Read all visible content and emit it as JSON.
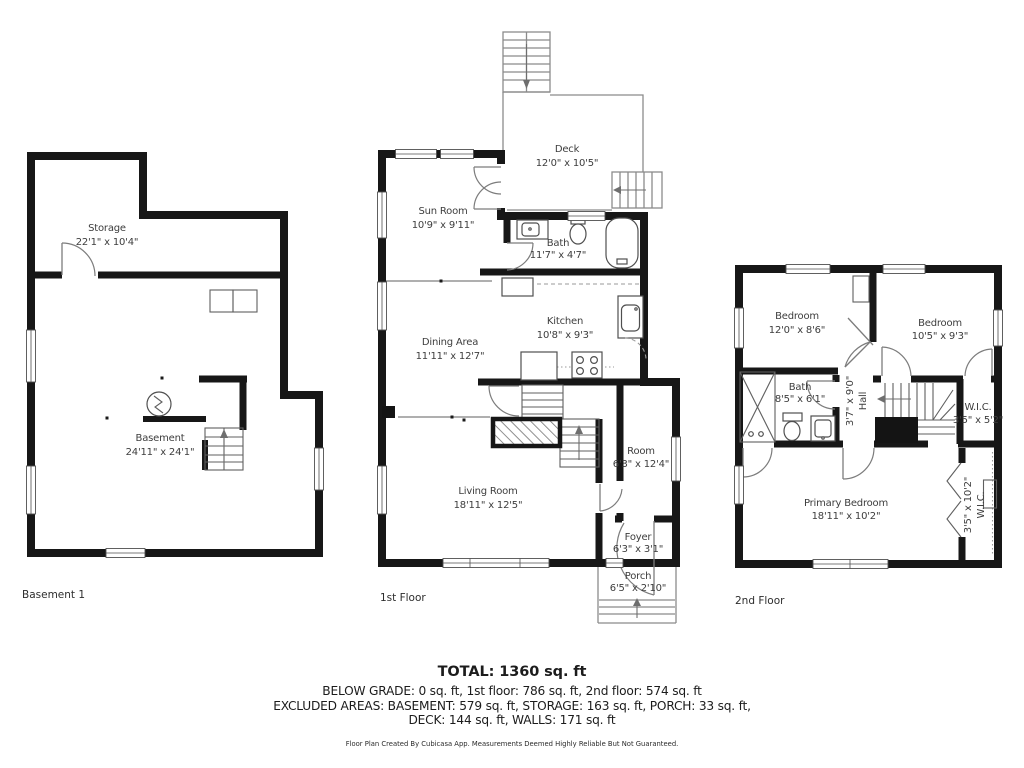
{
  "colors": {
    "wall": "#171717",
    "thin_line": "#8b8b8b",
    "label": "#3d3d3d",
    "background": "#ffffff"
  },
  "floors": [
    {
      "label": "Basement 1",
      "rooms": [
        {
          "name": "Storage",
          "dims": "22'1\" x 10'4\""
        },
        {
          "name": "Basement",
          "dims": "24'11\" x 24'1\""
        }
      ]
    },
    {
      "label": "1st Floor",
      "rooms": [
        {
          "name": "Deck",
          "dims": "12'0\" x 10'5\""
        },
        {
          "name": "Sun Room",
          "dims": "10'9\" x 9'11\""
        },
        {
          "name": "Bath",
          "dims": "11'7\" x 4'7\""
        },
        {
          "name": "Kitchen",
          "dims": "10'8\" x 9'3\""
        },
        {
          "name": "Dining Area",
          "dims": "11'11\" x 12'7\""
        },
        {
          "name": "Living Room",
          "dims": "18'11\" x 12'5\""
        },
        {
          "name": "Room",
          "dims": "6'3\" x 12'4\""
        },
        {
          "name": "Foyer",
          "dims": "6'3\" x 3'1\""
        },
        {
          "name": "Porch",
          "dims": "6'5\" x 2'10\""
        }
      ]
    },
    {
      "label": "2nd Floor",
      "rooms": [
        {
          "name": "Bedroom",
          "dims": "12'0\" x 8'6\""
        },
        {
          "name": "Bedroom",
          "dims": "10'5\" x 9'3\""
        },
        {
          "name": "Bath",
          "dims": "8'5\" x 6'1\""
        },
        {
          "name": "Hall",
          "dims": "3'7\" x 9'0\""
        },
        {
          "name": "W.I.C.",
          "dims": "3'5\" x 5'2\""
        },
        {
          "name": "Primary Bedroom",
          "dims": "18'11\" x 10'2\""
        },
        {
          "name": "W.I.C.",
          "dims": "3'5\" x 10'2\""
        }
      ]
    }
  ],
  "summary": {
    "total": "TOTAL: 1360 sq. ft",
    "line1": "BELOW GRADE: 0 sq. ft, 1st floor: 786 sq. ft, 2nd floor: 574 sq. ft",
    "line2": "EXCLUDED AREAS: BASEMENT: 579 sq. ft, STORAGE: 163 sq. ft, PORCH: 33 sq. ft,",
    "line3": "DECK: 144 sq. ft, WALLS: 171 sq. ft",
    "disclaimer": "Floor Plan Created By Cubicasa App. Measurements Deemed Highly Reliable But Not Guaranteed."
  }
}
